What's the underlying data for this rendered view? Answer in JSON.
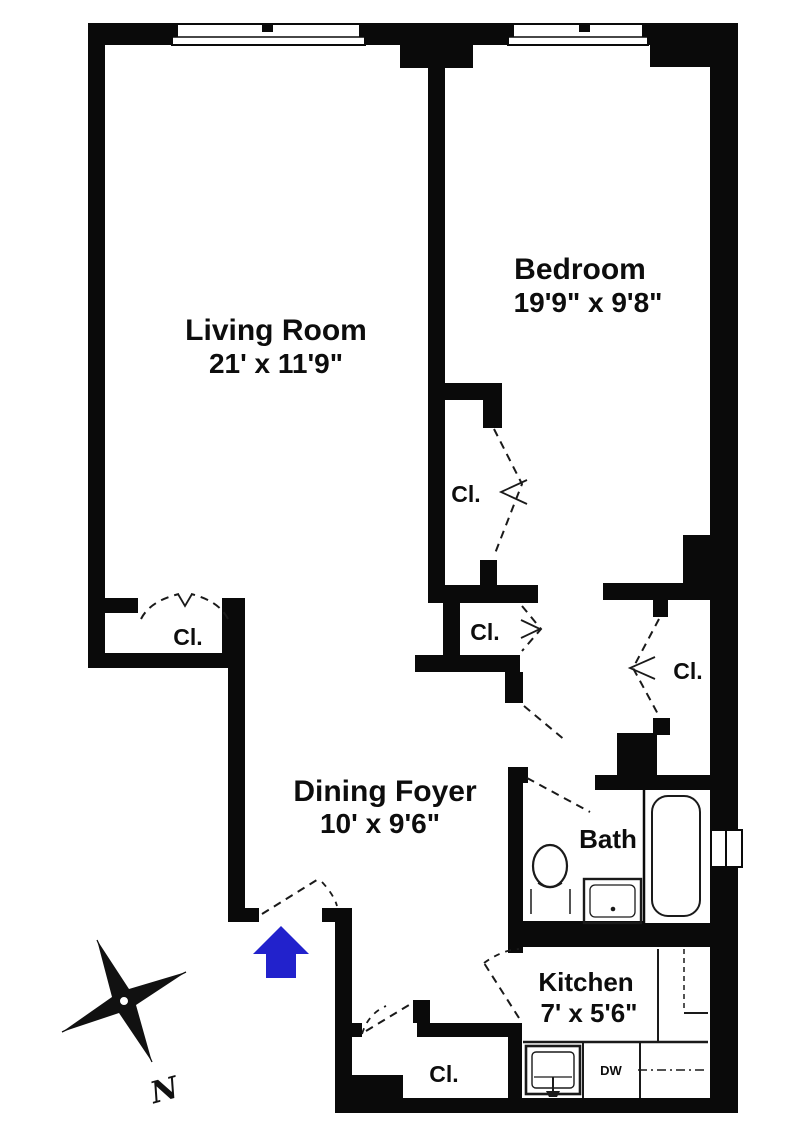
{
  "floorplan": {
    "rooms": {
      "living_room": {
        "name": "Living Room",
        "dimensions": "21' x 11'9\""
      },
      "bedroom": {
        "name": "Bedroom",
        "dimensions": "19'9\" x 9'8\""
      },
      "dining_foyer": {
        "name": "Dining Foyer",
        "dimensions": "10' x 9'6\""
      },
      "bath": {
        "name": "Bath"
      },
      "kitchen": {
        "name": "Kitchen",
        "dimensions": "7' x 5'6\""
      }
    },
    "closets": {
      "living_room_closet": "Cl.",
      "bedroom_closet": "Cl.",
      "hall_closet": "Cl.",
      "hall_closet_right": "Cl.",
      "foyer_closet": "Cl."
    },
    "appliances": {
      "dishwasher": "DW"
    },
    "compass": {
      "north": "N"
    },
    "colors": {
      "walls": "#0a0a0a",
      "entry_arrow": "#2222cc",
      "background": "#ffffff"
    }
  }
}
